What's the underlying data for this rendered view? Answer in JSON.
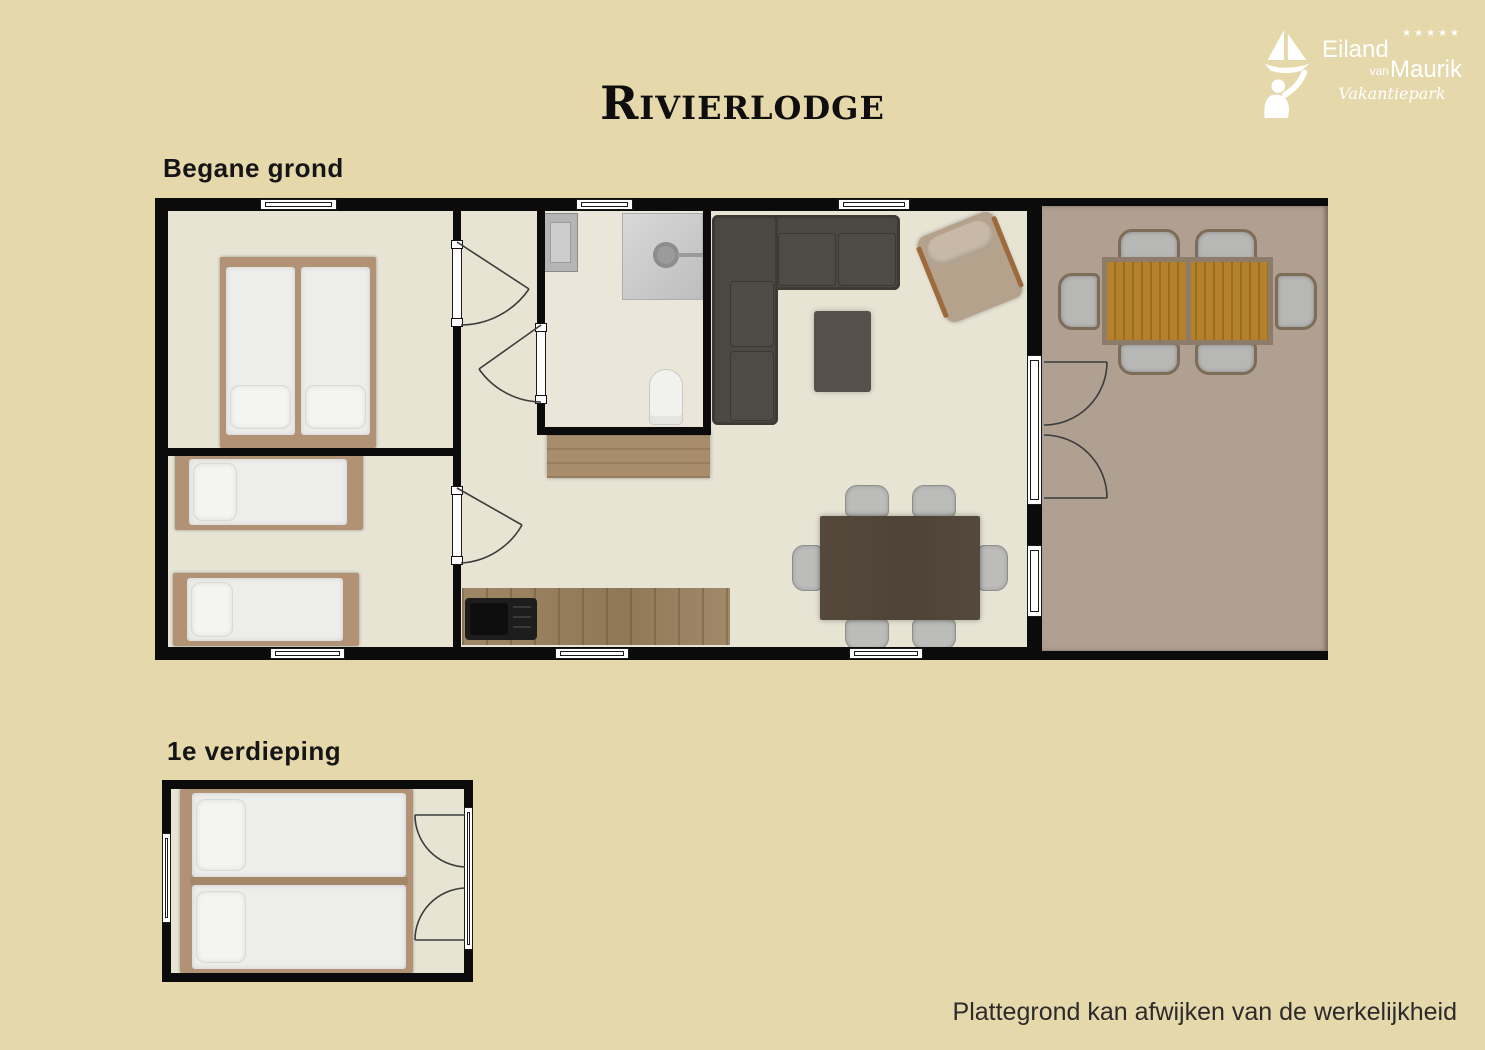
{
  "header": {
    "title": "Rivierlodge"
  },
  "logo": {
    "stars": "★★★★★",
    "name_line1": "Eiland",
    "name_van": "van",
    "name_line2": "Maurik",
    "subtitle": "Vakantiepark"
  },
  "floors": {
    "ground_label": "Begane grond",
    "first_label": "1e verdieping"
  },
  "footer": {
    "disclaimer": "Plattegrond kan afwijken van de werkelijkheid"
  },
  "palette": {
    "background": "#e5d8ab",
    "wall": "#0b0b0b",
    "floor": "#e7e4d4",
    "terrace": "#b0a092",
    "wood": "#b19275",
    "wood_dark": "#9c8462",
    "sofa": "#4b4743",
    "rug": "#57504a",
    "table": "#55493c",
    "chair": "#bcbcba",
    "lounge": "#b4a28d",
    "slat": "#b5812d",
    "white": "#ffffff"
  }
}
